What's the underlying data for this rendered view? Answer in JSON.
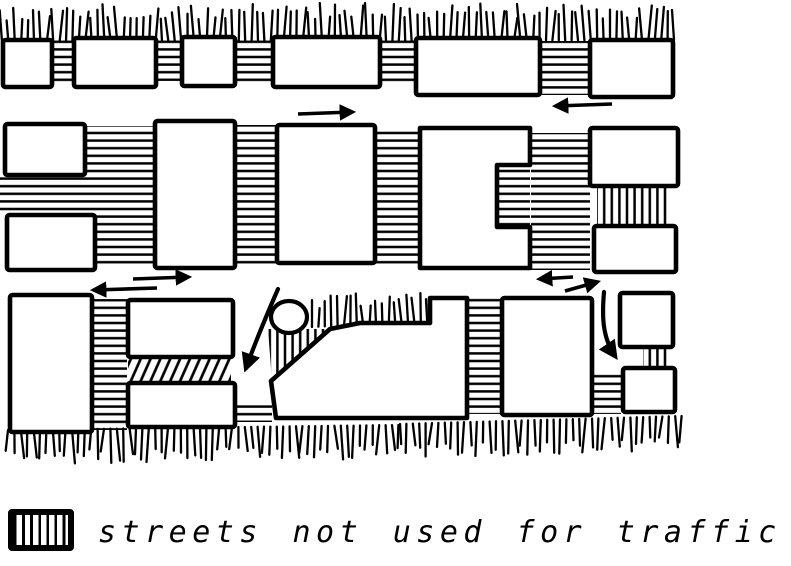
{
  "legend": {
    "swatch": "hatched-street-swatch",
    "label": "streets not used for traffic"
  },
  "colors": {
    "ink": "#000000",
    "paper": "#ffffff"
  },
  "diagram": {
    "width": 791,
    "height": 505,
    "hatch_spacing": 7.6,
    "elements": [
      {
        "t": "street",
        "x": 53,
        "y": 40,
        "w": 21,
        "h": 44,
        "o": "h"
      },
      {
        "t": "street",
        "x": 156,
        "y": 40,
        "w": 25,
        "h": 41,
        "o": "h"
      },
      {
        "t": "street",
        "x": 236,
        "y": 38,
        "w": 36,
        "h": 47,
        "o": "h"
      },
      {
        "t": "street",
        "x": 381,
        "y": 39,
        "w": 35,
        "h": 47,
        "o": "h"
      },
      {
        "t": "street",
        "x": 542,
        "y": 41,
        "w": 48,
        "h": 54,
        "o": "h"
      },
      {
        "t": "street",
        "x": 85,
        "y": 126,
        "w": 70,
        "h": 49,
        "o": "h"
      },
      {
        "t": "street",
        "x": 0,
        "y": 175,
        "w": 155,
        "h": 40,
        "o": "h"
      },
      {
        "t": "street",
        "x": 95,
        "y": 215,
        "w": 60,
        "h": 53,
        "o": "h"
      },
      {
        "t": "street",
        "x": 235,
        "y": 125,
        "w": 42,
        "h": 141,
        "o": "h"
      },
      {
        "t": "street",
        "x": 375,
        "y": 128,
        "w": 45,
        "h": 139,
        "o": "h"
      },
      {
        "t": "street",
        "x": 531,
        "y": 133,
        "w": 59,
        "h": 137,
        "o": "h"
      },
      {
        "t": "street",
        "x": 497,
        "y": 165,
        "w": 33,
        "h": 62,
        "o": "h"
      },
      {
        "t": "street",
        "x": 597,
        "y": 187,
        "w": 70,
        "h": 39,
        "o": "v"
      },
      {
        "t": "street",
        "x": 93,
        "y": 299,
        "w": 34,
        "h": 131,
        "o": "h"
      },
      {
        "t": "street",
        "x": 128,
        "y": 358,
        "w": 103,
        "h": 23,
        "o": "d"
      },
      {
        "t": "street",
        "x": 237,
        "y": 403,
        "w": 35,
        "h": 19,
        "o": "h"
      },
      {
        "t": "street",
        "x": 468,
        "y": 298,
        "w": 32,
        "h": 116,
        "o": "h"
      },
      {
        "t": "street",
        "x": 593,
        "y": 373,
        "w": 28,
        "h": 41,
        "o": "h"
      },
      {
        "t": "street",
        "x": 643,
        "y": 347,
        "w": 28,
        "h": 21,
        "o": "v"
      },
      {
        "t": "streetPoly",
        "pts": [
          [
            268,
            329
          ],
          [
            331,
            329
          ],
          [
            272,
            382
          ]
        ],
        "o": "v"
      },
      {
        "t": "fringe",
        "x1": 2,
        "x2": 671,
        "y1": 42,
        "y2": 40,
        "dir": "up",
        "len": 30
      },
      {
        "t": "fringe",
        "x1": 312,
        "x2": 428,
        "y1": 327,
        "y2": 322,
        "dir": "up",
        "len": 25
      },
      {
        "t": "fringe",
        "x1": 8,
        "x2": 400,
        "y1": 430,
        "y2": 425,
        "dir": "down",
        "len": 27
      },
      {
        "t": "fringe",
        "x1": 400,
        "x2": 680,
        "y1": 424,
        "y2": 416,
        "dir": "down",
        "len": 27
      },
      {
        "t": "block",
        "x": 3,
        "y": 40,
        "w": 49,
        "h": 47
      },
      {
        "t": "block",
        "x": 74,
        "y": 38,
        "w": 82,
        "h": 49
      },
      {
        "t": "block",
        "x": 182,
        "y": 37,
        "w": 53,
        "h": 49
      },
      {
        "t": "block",
        "x": 273,
        "y": 37,
        "w": 107,
        "h": 50
      },
      {
        "t": "block",
        "x": 416,
        "y": 38,
        "w": 124,
        "h": 57
      },
      {
        "t": "block",
        "x": 590,
        "y": 40,
        "w": 83,
        "h": 57
      },
      {
        "t": "block",
        "x": 5,
        "y": 124,
        "w": 80,
        "h": 51
      },
      {
        "t": "block",
        "x": 7,
        "y": 215,
        "w": 88,
        "h": 55
      },
      {
        "t": "block",
        "x": 155,
        "y": 121,
        "w": 80,
        "h": 147
      },
      {
        "t": "block",
        "x": 277,
        "y": 125,
        "w": 98,
        "h": 138
      },
      {
        "t": "blockPoly",
        "pts": [
          [
            420,
            128
          ],
          [
            530,
            128
          ],
          [
            530,
            165
          ],
          [
            497,
            165
          ],
          [
            497,
            227
          ],
          [
            530,
            227
          ],
          [
            530,
            268
          ],
          [
            420,
            268
          ]
        ]
      },
      {
        "t": "block",
        "x": 590,
        "y": 128,
        "w": 88,
        "h": 58
      },
      {
        "t": "block",
        "x": 594,
        "y": 226,
        "w": 82,
        "h": 46
      },
      {
        "t": "block",
        "x": 10,
        "y": 295,
        "w": 82,
        "h": 137
      },
      {
        "t": "block",
        "x": 128,
        "y": 300,
        "w": 105,
        "h": 57
      },
      {
        "t": "block",
        "x": 128,
        "y": 383,
        "w": 107,
        "h": 44
      },
      {
        "t": "blockPoly",
        "pts": [
          [
            330,
            329
          ],
          [
            360,
            323
          ],
          [
            430,
            323
          ],
          [
            430,
            298
          ],
          [
            467,
            298
          ],
          [
            467,
            418
          ],
          [
            276,
            418
          ],
          [
            271,
            381
          ]
        ]
      },
      {
        "t": "block",
        "x": 502,
        "y": 298,
        "w": 90,
        "h": 117
      },
      {
        "t": "block",
        "x": 620,
        "y": 293,
        "w": 53,
        "h": 54
      },
      {
        "t": "block",
        "x": 623,
        "y": 368,
        "w": 52,
        "h": 44
      },
      {
        "t": "circle",
        "cx": 289,
        "cy": 317,
        "rx": 18,
        "ry": 16
      },
      {
        "t": "arrow",
        "x1": 298,
        "y1": 114,
        "x2": 352,
        "y2": 112
      },
      {
        "t": "arrow",
        "x1": 612,
        "y1": 104,
        "x2": 556,
        "y2": 106
      },
      {
        "t": "arrow",
        "x1": 133,
        "y1": 279,
        "x2": 188,
        "y2": 277
      },
      {
        "t": "arrow",
        "x1": 157,
        "y1": 288,
        "x2": 94,
        "y2": 290
      },
      {
        "t": "arrow",
        "x1": 573,
        "y1": 277,
        "x2": 540,
        "y2": 279
      },
      {
        "t": "arrow",
        "x1": 565,
        "y1": 291,
        "x2": 597,
        "y2": 282
      },
      {
        "t": "curve",
        "d": "M 278 289 C 268 312 256 340 246 368"
      },
      {
        "t": "curve",
        "d": "M 604 292 C 602 315 602 337 615 356"
      }
    ]
  }
}
